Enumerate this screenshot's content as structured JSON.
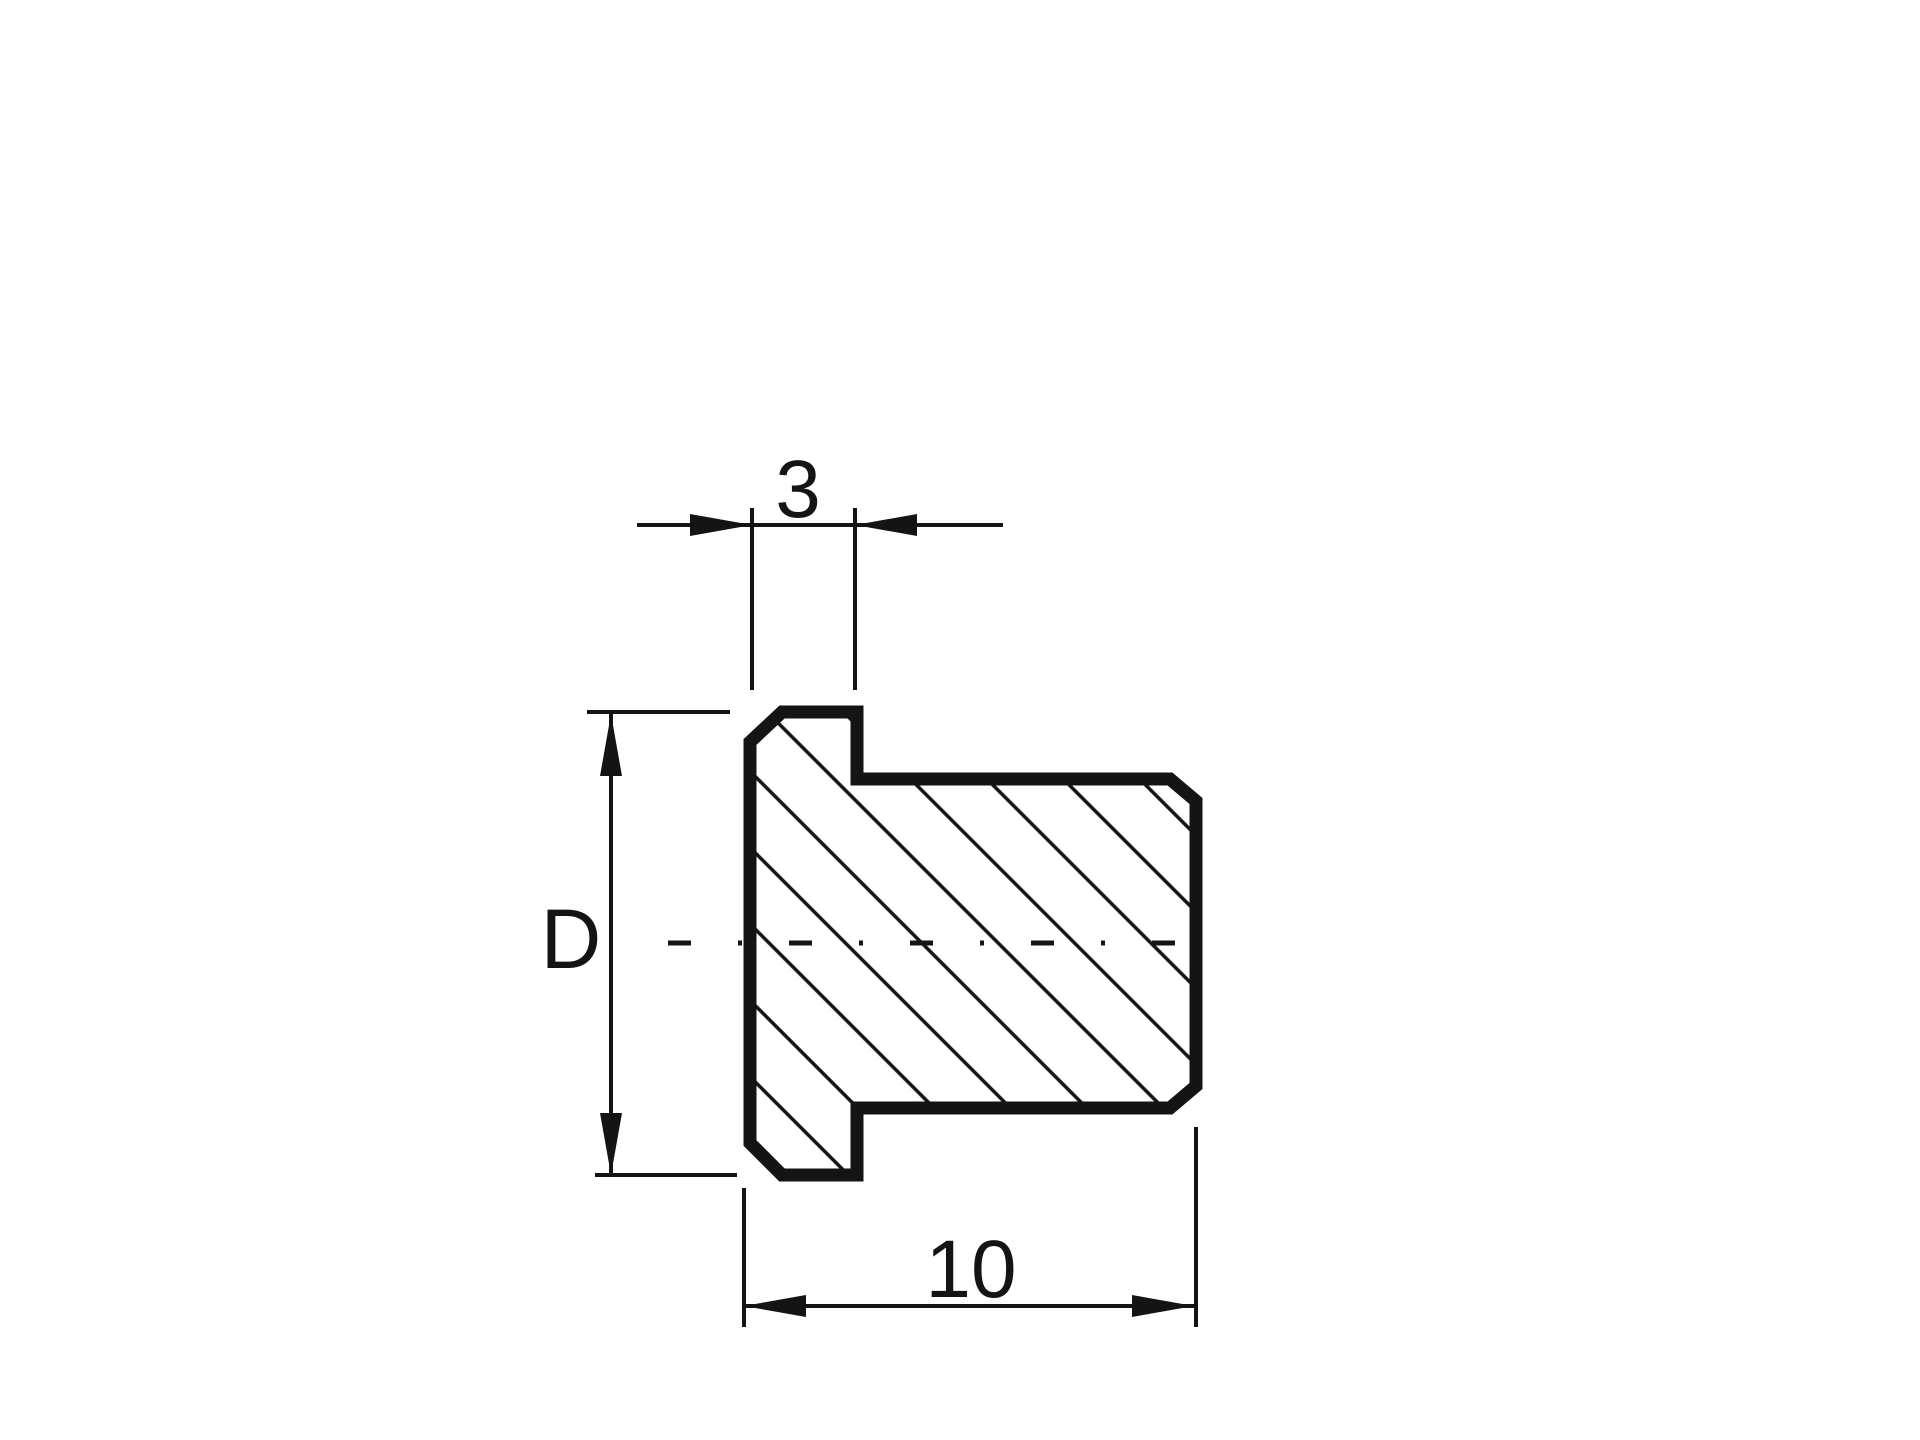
{
  "page": {
    "background_color": "#ffffff",
    "ink_color": "#141414"
  },
  "drawing": {
    "type": "technical-cross-section",
    "labels": {
      "flange_width": "3",
      "diameter": "D",
      "overall_length": "10"
    },
    "dimensions": [
      {
        "id": "flange-width-dimension",
        "label": "3",
        "orientation": "horizontal",
        "position": "top"
      },
      {
        "id": "diameter-dimension",
        "label": "D",
        "orientation": "vertical",
        "position": "left"
      },
      {
        "id": "overall-length-dimension",
        "label": "10",
        "orientation": "horizontal",
        "position": "bottom"
      }
    ]
  }
}
